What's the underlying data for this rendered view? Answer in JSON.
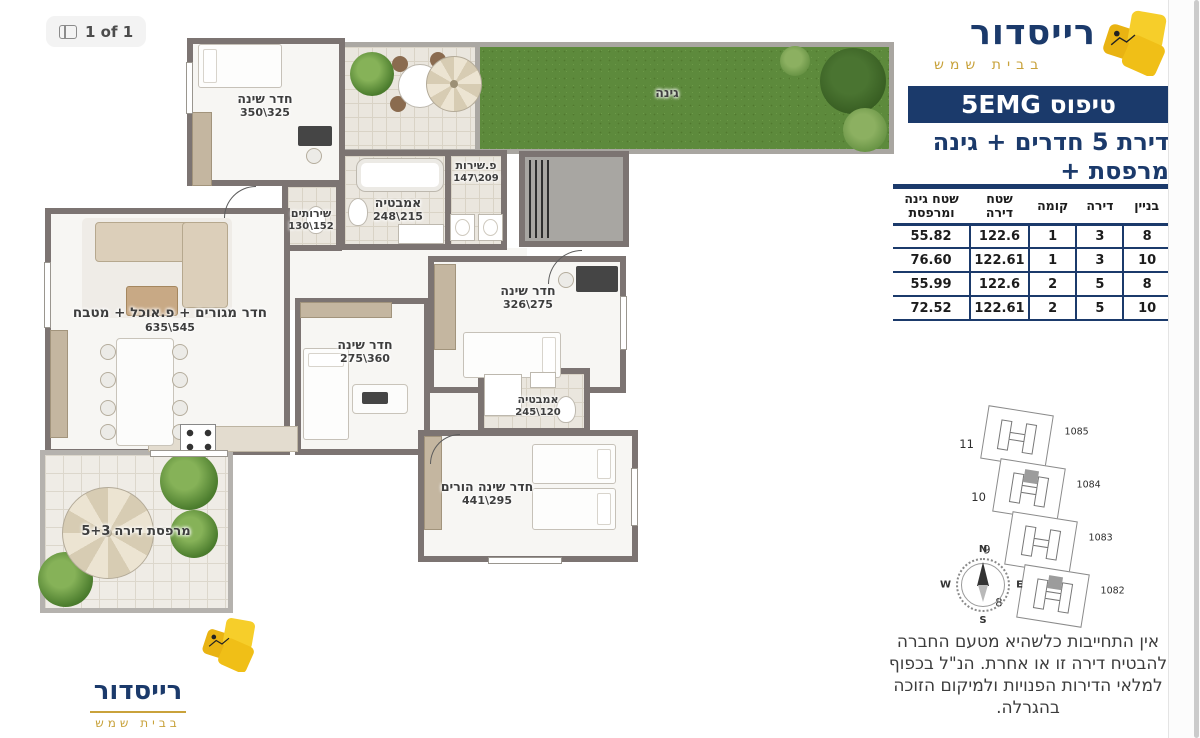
{
  "viewer": {
    "page_indicator": "1 of 1"
  },
  "brand": {
    "name": "רייסדור",
    "location": "בבית שמש"
  },
  "colors": {
    "navy": "#1b3a6b",
    "gold": "#c8a23b",
    "gem_yellow": "#f2c11e",
    "wall": "#7c7472",
    "grass": "#5d8a3c"
  },
  "header": {
    "type_label": "טיפוס 5EMG",
    "subtitle_line1": "דירת 5 חדרים + גינה",
    "subtitle_line2": "+ מרפסת"
  },
  "table": {
    "headers": [
      "בניין",
      "דירה",
      "קומה",
      "שטח דירה",
      "שטח גינה ומרפסת"
    ],
    "rows": [
      [
        "8",
        "3",
        "1",
        "122.6",
        "55.82"
      ],
      [
        "10",
        "3",
        "1",
        "122.61",
        "76.60"
      ],
      [
        "8",
        "5",
        "2",
        "122.6",
        "55.99"
      ],
      [
        "10",
        "5",
        "2",
        "122.61",
        "72.52"
      ]
    ]
  },
  "plan": {
    "rooms": {
      "garden": {
        "name": "גינה",
        "dims": ""
      },
      "bedroom_top": {
        "name": "חדר שינה",
        "dims": "350\\325"
      },
      "toilet": {
        "name": "שירותים",
        "dims": "130\\152"
      },
      "bath_main": {
        "name": "אמבטיה",
        "dims": "248\\215"
      },
      "utility": {
        "name": "פ.שירות",
        "dims": "147\\209"
      },
      "living": {
        "name": "חדר מגורים + פ.אוכל + מטבח",
        "dims": "635\\545"
      },
      "bedroom_mid": {
        "name": "חדר שינה",
        "dims": "275\\360"
      },
      "bedroom_right": {
        "name": "חדר שינה",
        "dims": "326\\275"
      },
      "bath_small": {
        "name": "אמבטיה",
        "dims": "245\\120"
      },
      "parents": {
        "name": "חדר שינה הורים",
        "dims": "441\\295"
      },
      "balcony": {
        "name": "מרפסת דירה",
        "dims": "5+3"
      }
    }
  },
  "sitemap": {
    "lots": [
      {
        "building": "11",
        "parcel": "1085",
        "highlight": false
      },
      {
        "building": "10",
        "parcel": "1084",
        "highlight": true
      },
      {
        "building": "9",
        "parcel": "1083",
        "highlight": false
      },
      {
        "building": "8",
        "parcel": "1082",
        "highlight": true
      }
    ],
    "compass": [
      "N",
      "E",
      "S",
      "W"
    ]
  },
  "disclaimer": "אין התחייבות כלשהיא מטעם החברה להבטיח דירה זו או אחרת. הנ\"ל בכפוף למלאי הדירות הפנויות ולמיקום הזוכה בהגרלה."
}
